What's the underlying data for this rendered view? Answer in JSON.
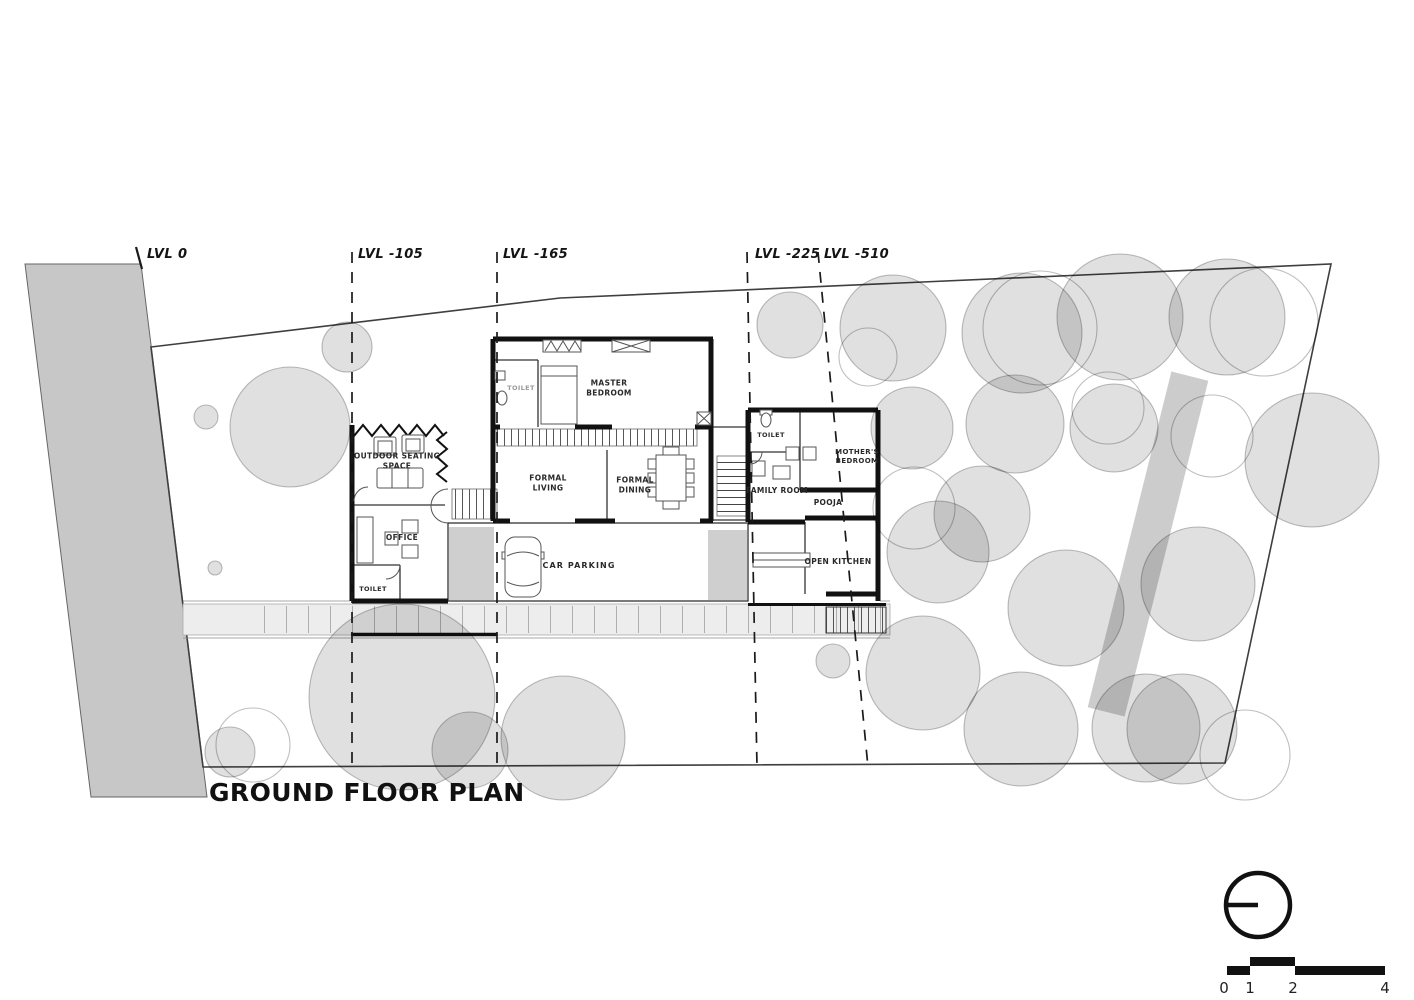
{
  "title": "GROUND FLOOR PLAN",
  "levels": [
    {
      "label": "LVL 0"
    },
    {
      "label": "LVL -105"
    },
    {
      "label": "LVL -165"
    },
    {
      "label": "LVL -225"
    },
    {
      "label": "LVL -510"
    }
  ],
  "rooms": {
    "master_toilet": "TOILET",
    "master_bedroom": "MASTER\nBEDROOM",
    "outdoor_seating": "OUTDOOR SEATING\nSPACE",
    "formal_living": "FORMAL\nLIVING",
    "formal_dining": "FORMAL\nDINING",
    "office": "OFFICE",
    "office_toilet": "TOILET",
    "car_parking": "CAR PARKING",
    "family_toilet": "TOILET",
    "family_room": "FAMILY ROOM",
    "mothers_bedroom": "MOTHER'S\nBEDROOM",
    "pooja": "POOJA",
    "open_kitchen": "OPEN KITCHEN"
  },
  "scale_bar": {
    "labels": [
      "0",
      "1",
      "2",
      "4"
    ]
  },
  "icons": {
    "north_arrow": "north-arrow"
  },
  "colors": {
    "wall": "#1a1a1a",
    "road_fill": "#c7c7c7",
    "tree_fill": "#d9d9d9",
    "column_fill": "#cfcfcf",
    "walkway_fill": "#ededed"
  }
}
